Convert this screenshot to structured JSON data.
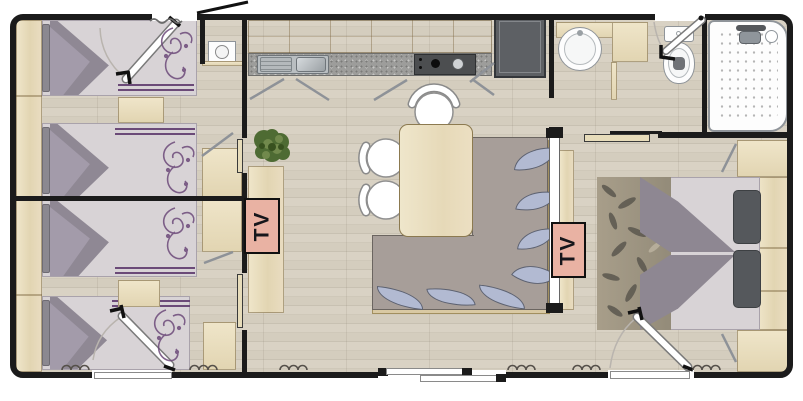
{
  "scene": {
    "width": 803,
    "height": 401,
    "type": "mobile-home floor plan, top view"
  },
  "tv_units": [
    {
      "label": "TV",
      "location": "left bedroom wall sideboard"
    },
    {
      "label": "TV",
      "location": "master bedroom sideboard"
    }
  ],
  "colors": {
    "wall": "#1b1b1b",
    "floor_wood": "#d5cec0",
    "furniture_wood": "#e9ddbc",
    "tv_panel": "#e9b2a3",
    "bedding_accent_purple": "#6b4a78",
    "mattress": "#d8d3d6",
    "sofa": "#a79e99",
    "cushion_blue": "#b2bad2",
    "counter_granite": "#9d9d9b",
    "plant_green": "#4e6b33"
  },
  "icons": [
    "single-bed-icon",
    "double-bed-icon",
    "nightstand-icon",
    "wardrobe-icon",
    "tv-icon",
    "sofa-icon",
    "cushion-icon",
    "dining-table-icon",
    "chair-icon",
    "plant-icon",
    "kitchen-sink-icon",
    "stove-icon",
    "fridge-icon",
    "boiler-icon",
    "washbasin-icon",
    "toilet-icon",
    "shower-icon",
    "door-swing-icon",
    "sliding-door-icon"
  ]
}
